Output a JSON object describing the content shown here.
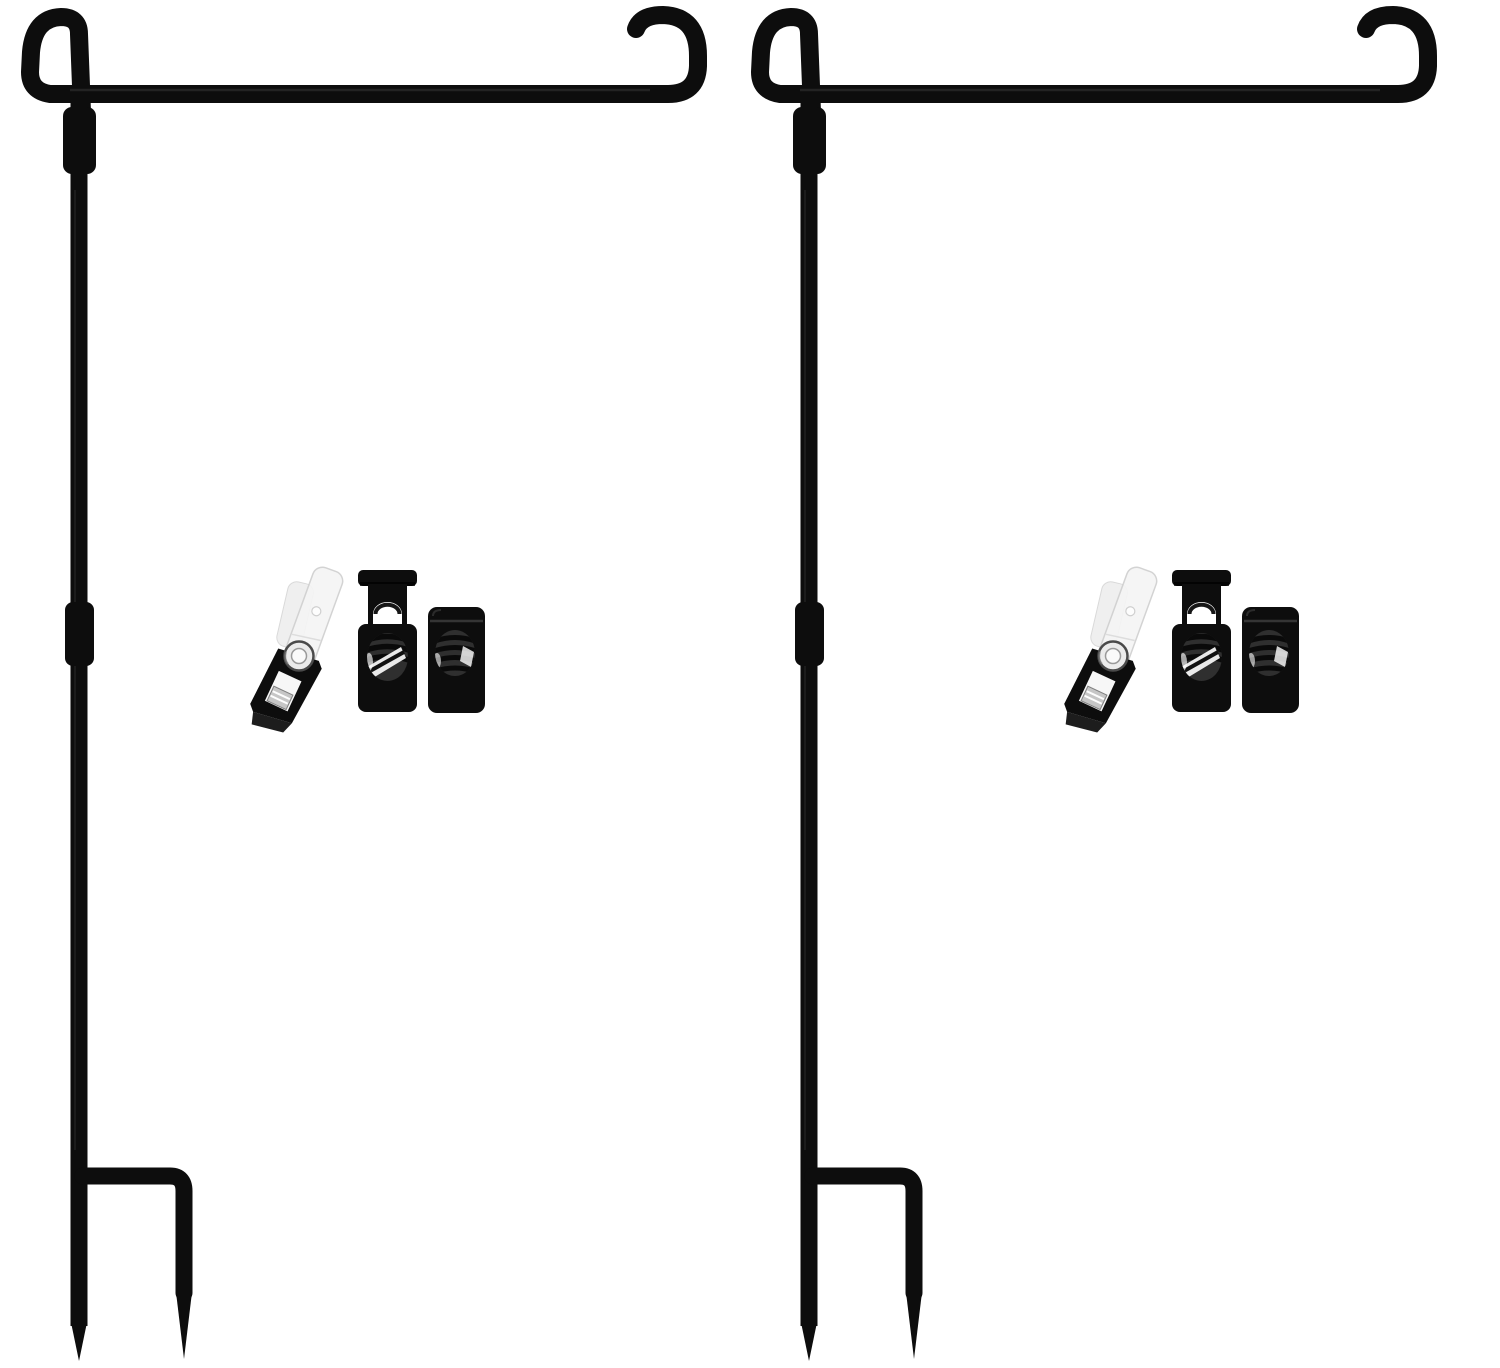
{
  "meta": {
    "type": "product-photo",
    "description": "Two black wrought-iron garden flag pole stands shown side by side on a white background; each stand is shown with an accessory kit containing one clear vinyl flag clip with a metal snap rivet and two black spring-loaded cord stopper locks.",
    "background": "#ffffff"
  },
  "colors": {
    "iron_black": "#0d0d0d",
    "highlight_gray": "#3a3a3a",
    "window_gray": "#2f2f2f",
    "coil_black": "#0a0a0a",
    "window_white": "#ffffff",
    "strap_white": "#f5f5f5",
    "strap_edge": "#d0d0d0",
    "rivet_silver": "#ebebeb",
    "rivet_ring": "#4a4a4a",
    "rivet_core": "#fafafa",
    "metal_tab": "#c6c6c6",
    "clip_shadow_face": "#1d1d1d"
  },
  "items": {
    "stands": [
      {
        "name": "garden flag stand (left)",
        "parts": [
          "decorative top loop",
          "horizontal hanger bar",
          "anti-slip candy-cane hook",
          "upper collar joint",
          "vertical pole",
          "middle collar joint",
          "foot-step arm",
          "twin ground spikes"
        ]
      },
      {
        "name": "garden flag stand (right)",
        "parts": [
          "decorative top loop",
          "horizontal hanger bar",
          "anti-slip candy-cane hook",
          "upper collar joint",
          "vertical pole",
          "middle collar joint",
          "foot-step arm",
          "twin ground spikes"
        ]
      }
    ],
    "accessory_kits": [
      {
        "name": "accessory kit (left)",
        "contents": [
          "clear vinyl flag clip with snap rivet",
          "tall spring cord stopper",
          "short spring cord stopper"
        ]
      },
      {
        "name": "accessory kit (right)",
        "contents": [
          "clear vinyl flag clip with snap rivet",
          "tall spring cord stopper",
          "short spring cord stopper"
        ]
      }
    ]
  }
}
